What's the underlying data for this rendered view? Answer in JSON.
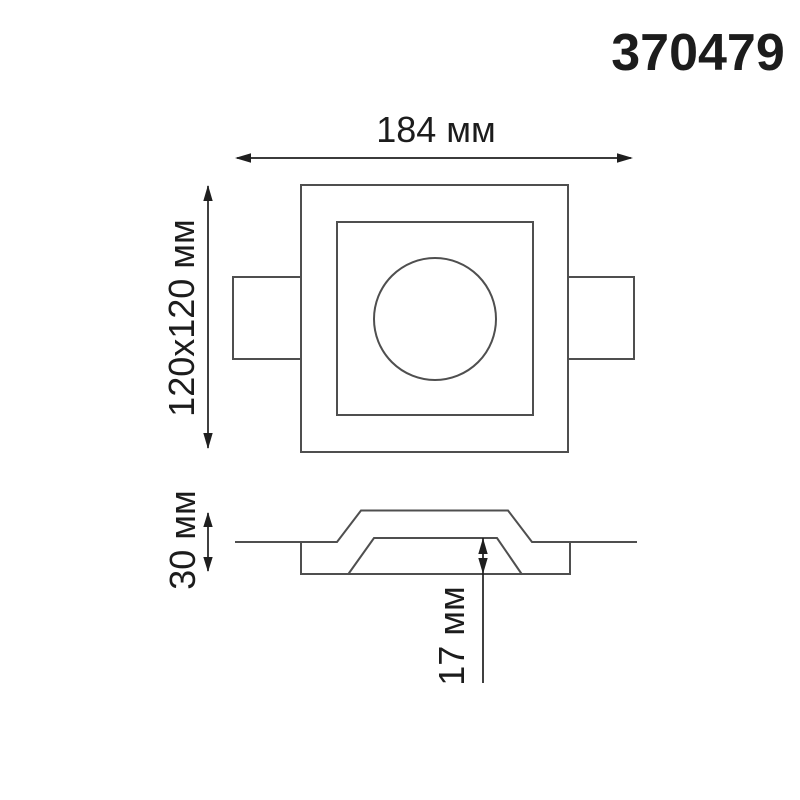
{
  "product_code": "370479",
  "dimensions": {
    "width": "184 мм",
    "face": "120x120 мм",
    "height": "30 мм",
    "recess_depth": "17 мм"
  },
  "values": {
    "width_mm": 184,
    "face_mm": "120x120",
    "height_mm": 30,
    "recess_depth_mm": 17
  },
  "colors": {
    "line": "#4f4f4f",
    "dim": "#1f1f1f",
    "text": "#1c1c1c",
    "background": "#ffffff"
  }
}
